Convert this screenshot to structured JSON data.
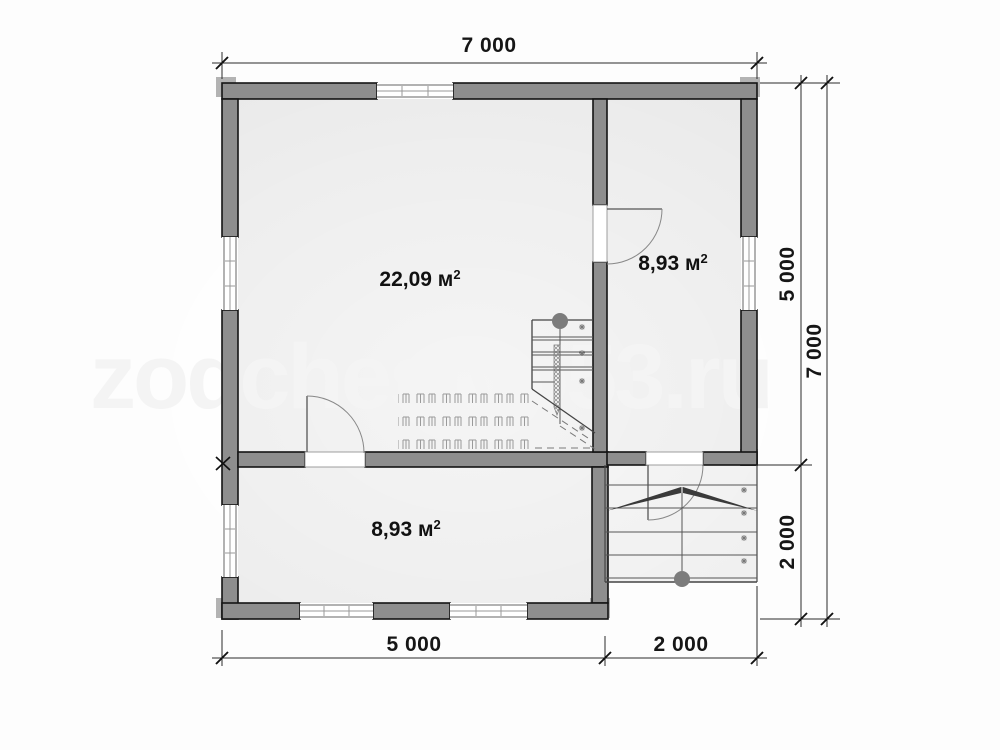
{
  "plan": {
    "watermark": "zodchestvo53.ru",
    "rooms": {
      "living": {
        "area": "22,09 м",
        "sup": "2"
      },
      "top_right": {
        "area": "8,93 м",
        "sup": "2"
      },
      "bottom": {
        "area": "8,93 м",
        "sup": "2"
      }
    },
    "dimensions": {
      "top_width": "7 000",
      "right_upper": "5 000",
      "right_lower": "2 000",
      "right_total": "7 000",
      "bottom_left": "5 000",
      "bottom_right": "2 000"
    },
    "colors": {
      "wall": "#8e8e8e",
      "floor": "#e9e9e9",
      "porch_floor": "#ededed",
      "outline": "#141414",
      "dim_line": "#2a2a2a",
      "watermark": "#f4f4f4",
      "stair_knob": "#7c7c7c",
      "dim_text": "#161616"
    }
  }
}
